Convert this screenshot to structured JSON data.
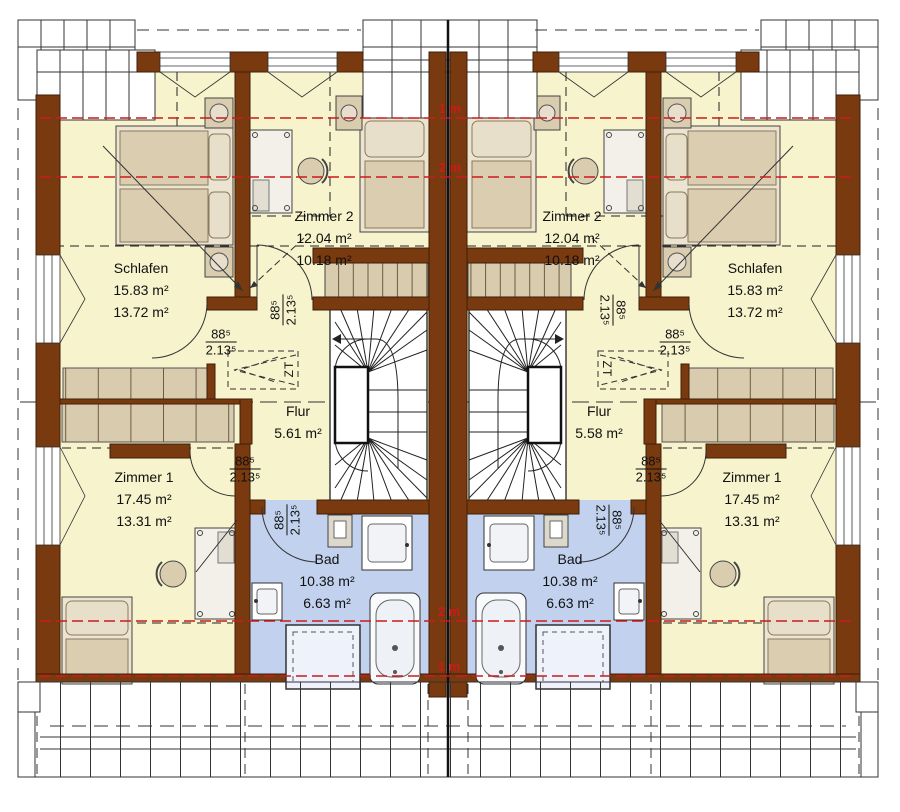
{
  "left_unit": {
    "schlafen": {
      "name": "Schlafen",
      "area_total": "15.83 m²",
      "area_living": "13.72 m²"
    },
    "zimmer2": {
      "name": "Zimmer 2",
      "area_total": "12.04 m²",
      "area_living": "10.18 m²"
    },
    "zimmer1": {
      "name": "Zimmer 1",
      "area_total": "17.45 m²",
      "area_living": "13.31 m²"
    },
    "flur": {
      "name": "Flur",
      "area_total": "5.61 m²"
    },
    "bad": {
      "name": "Bad",
      "area_total": "10.38 m²",
      "area_living": "6.63 m²"
    },
    "hatch_label": "ZT"
  },
  "right_unit": {
    "schlafen": {
      "name": "Schlafen",
      "area_total": "15.83 m²",
      "area_living": "13.72 m²"
    },
    "zimmer2": {
      "name": "Zimmer 2",
      "area_total": "12.04 m²",
      "area_living": "10.18 m²"
    },
    "zimmer1": {
      "name": "Zimmer 1",
      "area_total": "17.45 m²",
      "area_living": "13.31 m²"
    },
    "flur": {
      "name": "Flur",
      "area_total": "5.58 m²"
    },
    "bad": {
      "name": "Bad",
      "area_total": "10.38 m²",
      "area_living": "6.63 m²"
    },
    "hatch_label": "ZT"
  },
  "door_dimension": {
    "width_cm": "88⁵",
    "height_m": "2.13⁵"
  },
  "height_marks": {
    "top_1m": "1 m",
    "top_2m": "2 m",
    "bottom_2m": "2 m",
    "bottom_1m": "1 m"
  },
  "colors": {
    "wall_brown": "#7a3a10",
    "room_yellow": "#f7f3cd",
    "bath_blue": "#c2d2ee",
    "furniture_beige": "#d8cbae",
    "height_line_red": "#cc1a1a"
  }
}
